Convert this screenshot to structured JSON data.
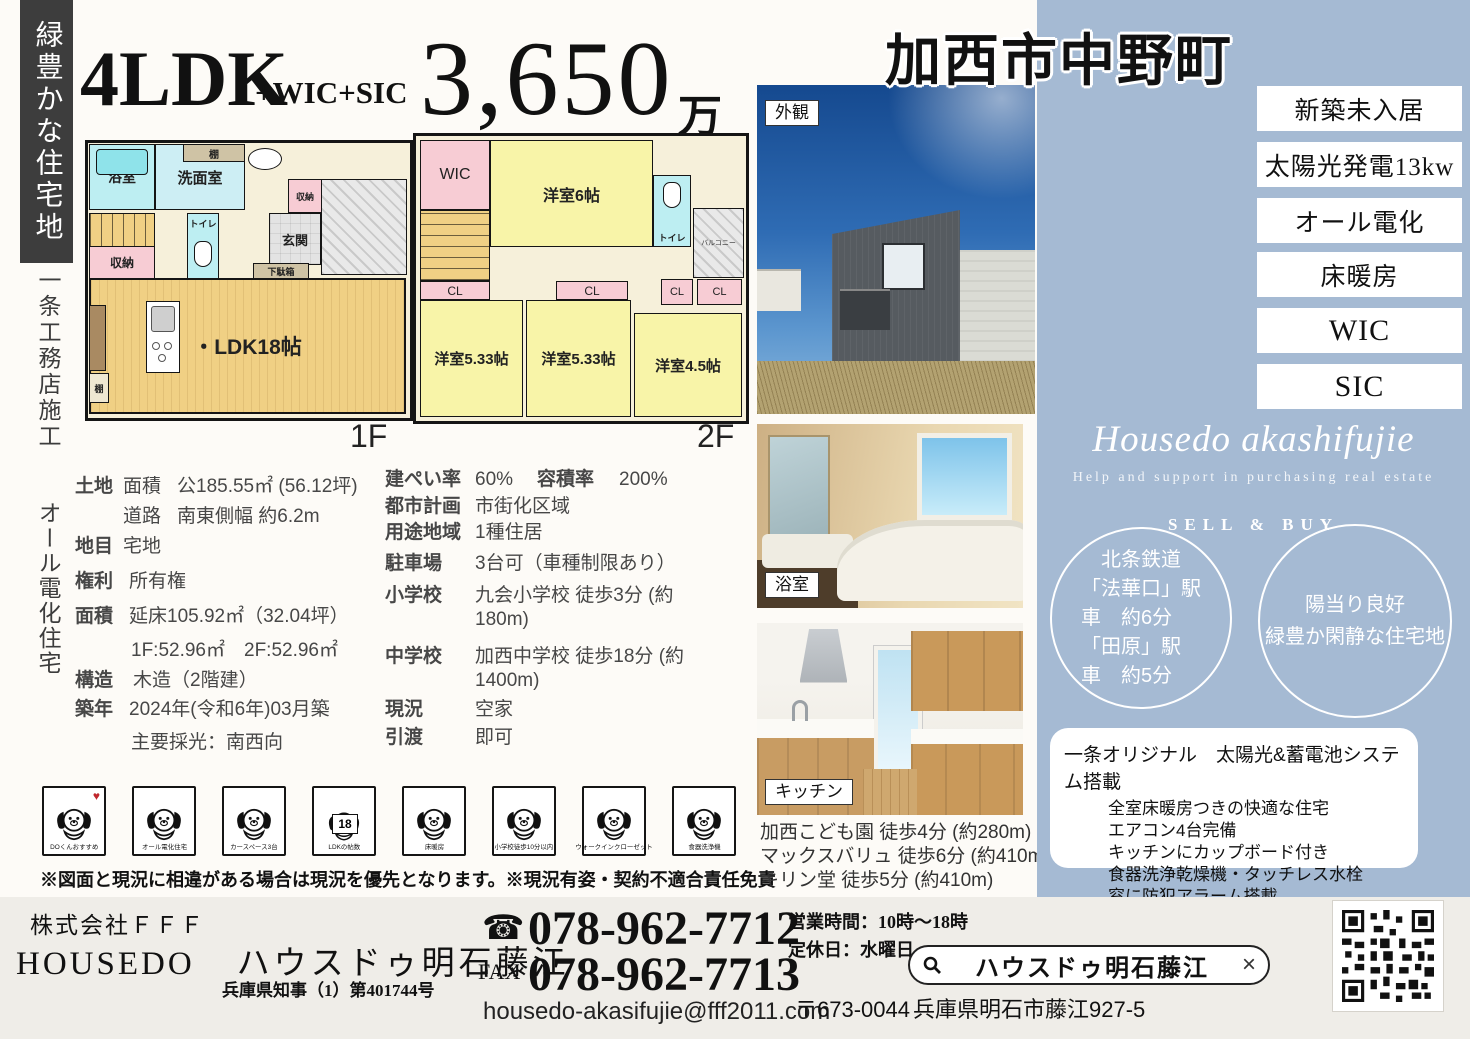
{
  "left_rail": {
    "banner": "緑豊かな住宅地",
    "note1": "一条工務店施工",
    "note2": "オール電化住宅"
  },
  "header": {
    "layout": "4LDK",
    "layout_suffix": "+WIC+SIC",
    "price": "3,650",
    "price_unit": "万"
  },
  "floorplan_1f": {
    "bath": "浴室",
    "shelf_top": "棚",
    "washroom": "洗面室",
    "storage_right": "収納",
    "toilet": "トイレ",
    "entrance": "玄関",
    "shoe_box": "下駄箱",
    "storage_left": "収納",
    "ldk": "・LDK18帖",
    "shelf_bottom": "棚",
    "floor_label": "1F"
  },
  "floorplan_2f": {
    "wic": "WIC",
    "room6": "洋室6帖",
    "toilet": "トイレ",
    "balcony": "バルコニー",
    "cl1": "CL",
    "cl2": "CL",
    "cl3": "CL",
    "cl4": "CL",
    "room533a": "洋室5.33帖",
    "room533b": "洋室5.33帖",
    "room45": "洋室4.5帖",
    "floor_label": "2F"
  },
  "details_left": [
    {
      "label": "土地",
      "sub": "面積",
      "value": "公185.55㎡ (56.12坪)"
    },
    {
      "label": "",
      "sub": "道路",
      "value": "南東側幅 約6.2m"
    },
    {
      "label": "地目",
      "sub": "",
      "value": "宅地"
    },
    {
      "label": "権利",
      "sub": "",
      "value": "所有権"
    },
    {
      "label": "面積",
      "sub": "",
      "value": "延床105.92㎡（32.04坪）"
    },
    {
      "label": "",
      "sub": "",
      "value": "1F:52.96㎡　2F:52.96㎡"
    },
    {
      "label": "構造",
      "sub": "",
      "value": "木造（2階建）"
    },
    {
      "label": "築年",
      "sub": "",
      "value": "2024年(令和6年)03月築"
    },
    {
      "label": "",
      "sub": "",
      "value": "主要採光：南西向"
    }
  ],
  "details_right": [
    {
      "label": "建ぺい率",
      "value": "60%",
      "label2": "容積率",
      "value2": "200%"
    },
    {
      "label": "都市計画",
      "value": "市街化区域"
    },
    {
      "label": "用途地域",
      "value": "1種住居"
    },
    {
      "label": "駐車場",
      "value": "3台可（車種制限あり）"
    },
    {
      "label": "小学校",
      "value": "九会小学校 徒歩3分 (約180m)"
    },
    {
      "label": "中学校",
      "value": "加西中学校 徒歩18分 (約1400m)"
    },
    {
      "label": "現況",
      "value": "空家"
    },
    {
      "label": "引渡",
      "value": "即可"
    }
  ],
  "feature_icons": [
    {
      "label": "DOくんおすすめ"
    },
    {
      "label": "オール電化住宅"
    },
    {
      "label": "カースペース3台"
    },
    {
      "label": "LDKの帖数",
      "plate": "18"
    },
    {
      "label": "床暖房"
    },
    {
      "label": "小学校徒歩10分以内"
    },
    {
      "label": "ウォークインクローゼット"
    },
    {
      "label": "食器洗浄機"
    }
  ],
  "disclaimer": "※図面と現況に相違がある場合は現況を優先となります。※現況有姿・契約不適合責任免責",
  "photos": {
    "exterior_label": "外観",
    "bath_label": "浴室",
    "kitchen_label": "キッチン",
    "distances": [
      "加西こども園 徒歩4分 (約280m)",
      "マックスバリュ 徒歩6分 (約410m)",
      "キリン堂 徒歩5分 (約410m)"
    ]
  },
  "right_panel": {
    "title": "加西市中野町",
    "badges": [
      "新築未入居",
      "太陽光発電13kw",
      "オール電化",
      "床暖房",
      "WIC",
      "SIC"
    ],
    "brand_script": "Housedo akashifujie",
    "brand_sub": "Help and support in purchasing real estate",
    "sell_buy": "SELL & BUY",
    "circle_left": [
      "北条鉄道",
      "「法華口」駅",
      "車　約6分",
      "「田原」駅",
      "車　約5分"
    ],
    "circle_right": [
      "陽当り良好",
      "緑豊か閑静な住宅地"
    ],
    "feature_box": {
      "title": "一条オリジナル　太陽光&蓄電池システム搭載",
      "items": [
        "全室床暖房つきの快適な住宅",
        "エアコン4台完備",
        "キッチンにカップボード付き",
        "食器洗浄乾燥機・タッチレス水栓",
        "窓に防犯アラーム搭載"
      ]
    }
  },
  "footer": {
    "company": "株式会社ＦＦＦ",
    "brand": "HOUSEDO",
    "store": "ハウスドゥ明石藤江",
    "license": "兵庫県知事（1）第401744号",
    "tel": "078-962-7712",
    "fax_label": "FAX",
    "fax": "078-962-7713",
    "email": "housedo-akasifujie@fff2011.com",
    "hours": "営業時間：10時～18時",
    "holiday": "定休日：水曜日",
    "search_text": "ハウスドゥ明石藤江",
    "postal": "〒673-0044",
    "address": "兵庫県明石市藤江927-5"
  }
}
